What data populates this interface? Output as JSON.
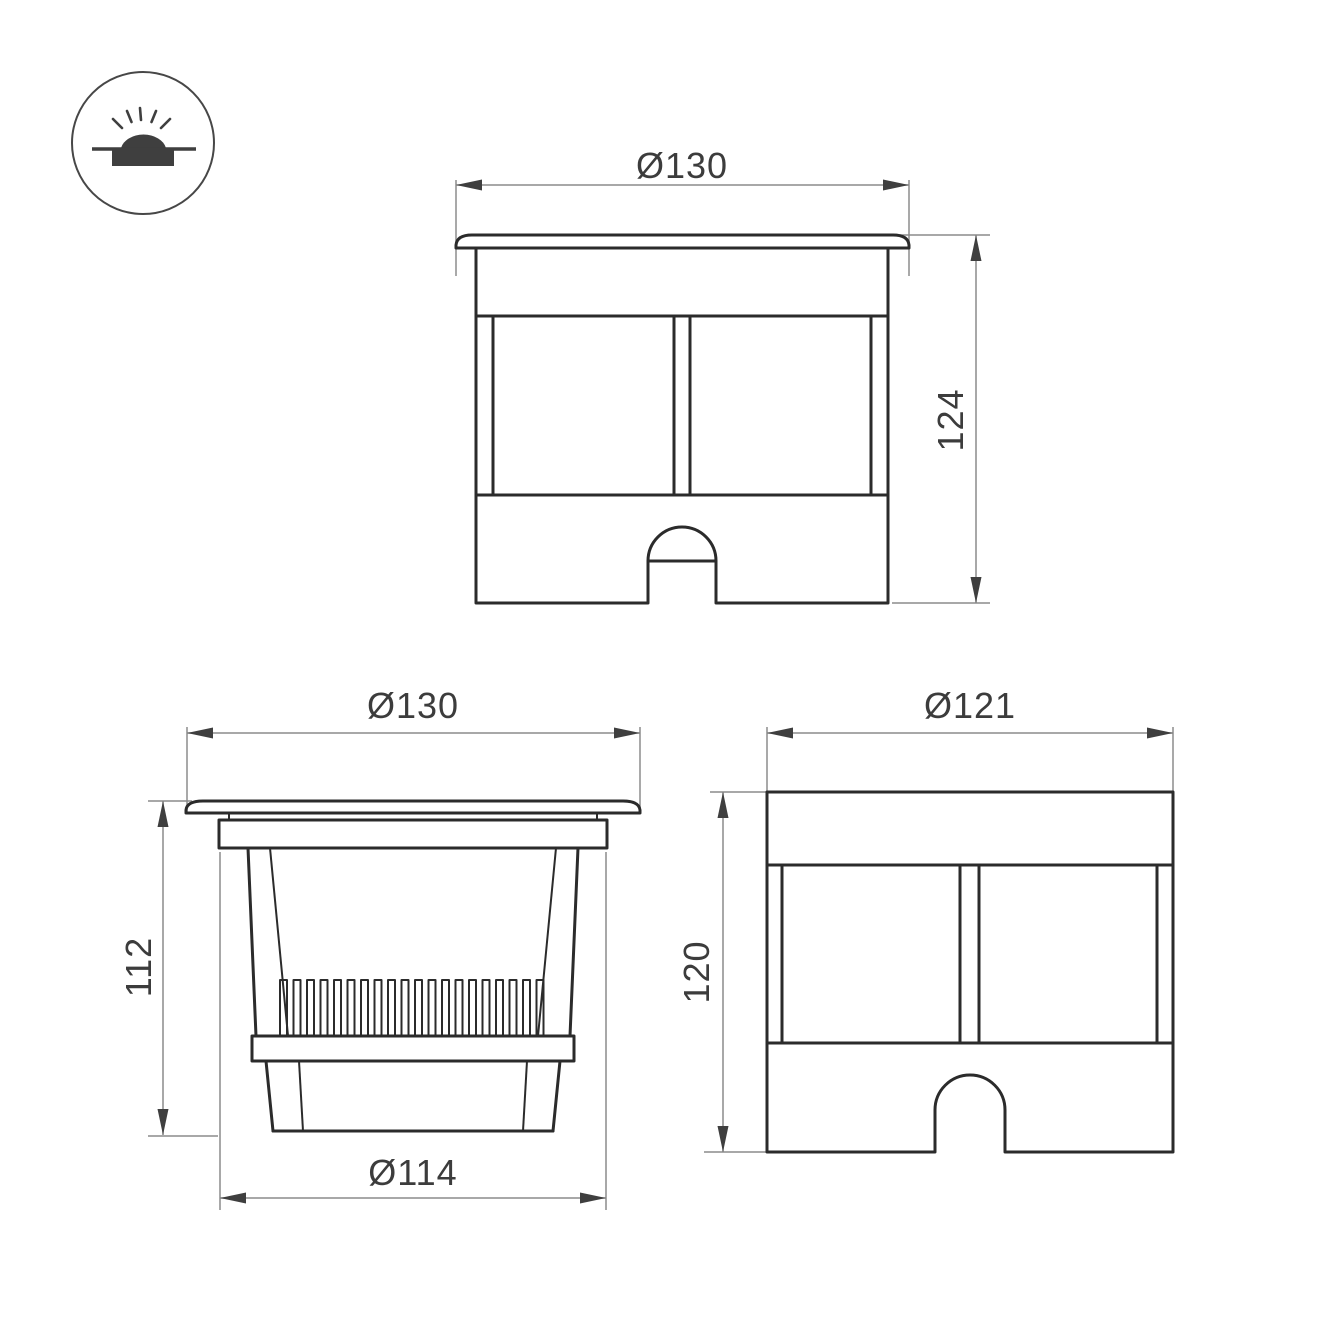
{
  "icon": {
    "symbol": "in-ground-recessed-luminaire"
  },
  "colors": {
    "outline": "#2b2b2b",
    "dimension_line": "#8c8c8c",
    "text": "#3c3c3c",
    "background": "#ffffff"
  },
  "views": {
    "front": {
      "label_width": "Ø130",
      "label_height": "124"
    },
    "section": {
      "label_width": "Ø130",
      "label_height": "112",
      "label_base": "Ø114"
    },
    "body": {
      "label_width": "Ø121",
      "label_height": "120"
    }
  }
}
